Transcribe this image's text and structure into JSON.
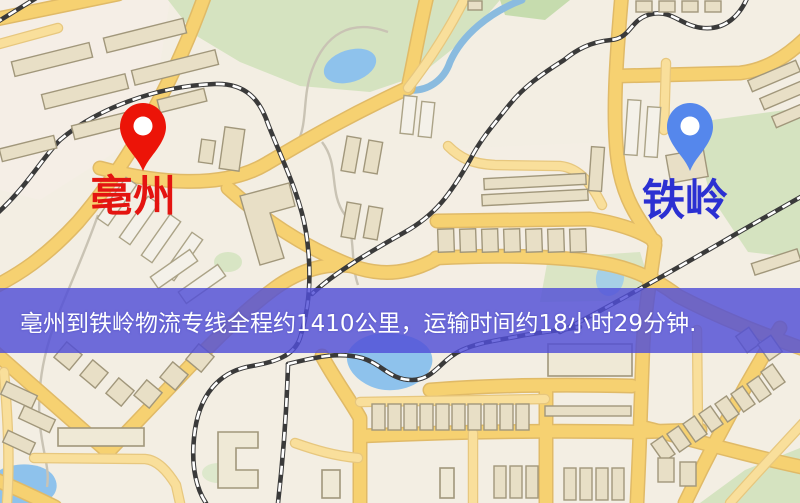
{
  "banner": {
    "text": "亳州到铁岭物流专线全程约1410公里，运输时间约18小时29分钟.",
    "background_color": "#504ed7",
    "text_color": "#ffffff",
    "distance_text": "1410公里",
    "duration_text": "18小时29分钟"
  },
  "markers": {
    "origin": {
      "label": "亳州",
      "pin_color": "#ec1408",
      "label_color": "#e41410"
    },
    "destination": {
      "label": "铁岭",
      "pin_color": "#5587ec",
      "label_color": "#2b30d2"
    }
  },
  "map_colors": {
    "background": "#f3eee3",
    "road_major": "#f6d171",
    "road_minor": "#f9df9b",
    "park": "#d5e3c0",
    "water": "#8ec2ec",
    "railway": "#3a3a3a",
    "building": "#e8dfc6"
  }
}
